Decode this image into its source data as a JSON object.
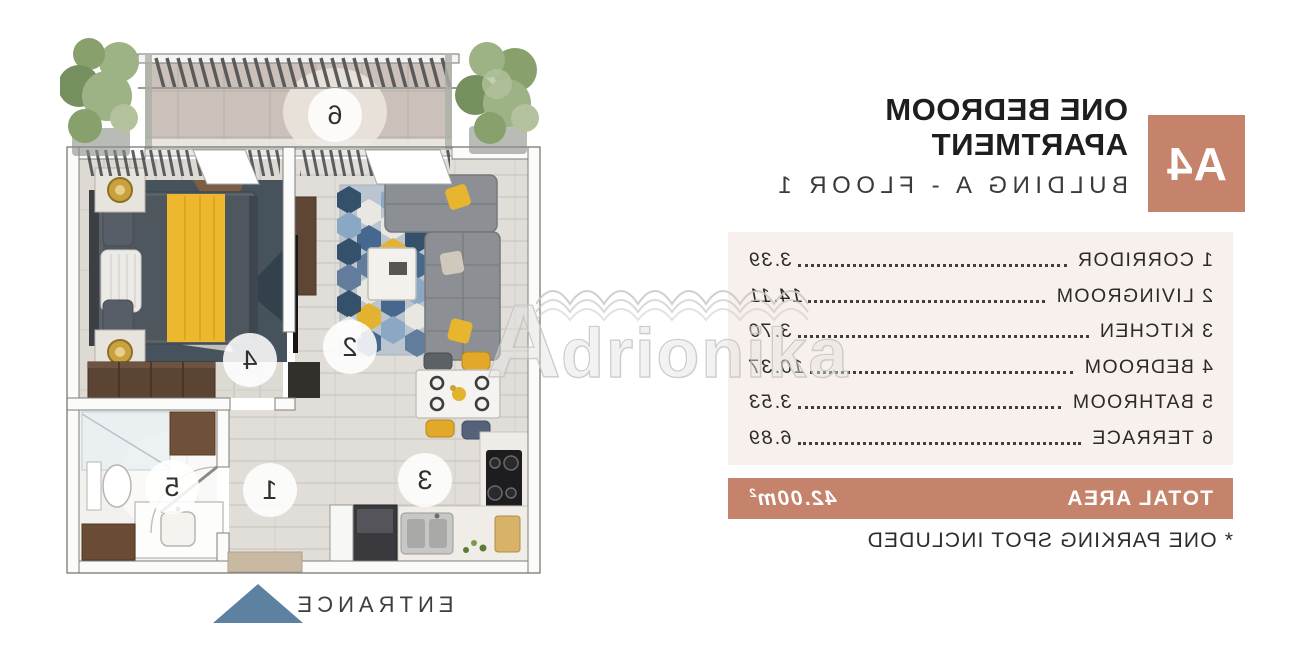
{
  "unit": {
    "code": "A4",
    "title_line1": "ONE BEDROOM",
    "title_line2": "APARTMENT",
    "subtitle": "BULDING A -  FLOOR 1"
  },
  "rooms": [
    {
      "num": "1",
      "name": "CORRIDOR",
      "area": "3.39"
    },
    {
      "num": "2",
      "name": "LIVINGROOM",
      "area": "14.11"
    },
    {
      "num": "3",
      "name": "KITCHEN",
      "area": "3.70"
    },
    {
      "num": "4",
      "name": "BEDROOM",
      "area": "10.37"
    },
    {
      "num": "5",
      "name": "BATHROOM",
      "area": "3.53"
    },
    {
      "num": "6",
      "name": "TERRACE",
      "area": "6.89"
    }
  ],
  "total": {
    "label": "TOTAL AREA",
    "value": "42.00m",
    "sup": "2"
  },
  "footnote": "* ONE PARKING SPOT INCLUDED",
  "plan": {
    "entrance_label": "ENTRANCE"
  },
  "watermark": {
    "text_first": "A",
    "text_rest": "drionika"
  },
  "colors": {
    "accent": "#c5836c",
    "panel_bg": "#f8f0ec",
    "arrow": "#5d81a0",
    "text_dark": "#2b2b2b"
  }
}
